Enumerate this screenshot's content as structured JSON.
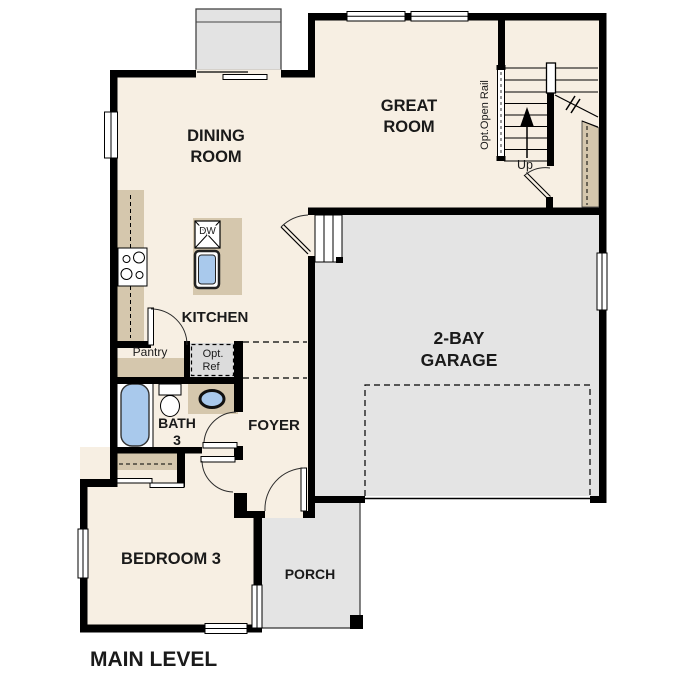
{
  "title": "MAIN LEVEL",
  "rooms": {
    "dining": {
      "line1": "DINING",
      "line2": "ROOM"
    },
    "great": {
      "line1": "GREAT",
      "line2": "ROOM"
    },
    "kitchen": {
      "label": "KITCHEN"
    },
    "garage": {
      "line1": "2-BAY",
      "line2": "GARAGE"
    },
    "bath": {
      "line1": "BATH",
      "line2": "3"
    },
    "foyer": {
      "label": "FOYER"
    },
    "bedroom": {
      "label": "BEDROOM 3"
    },
    "porch": {
      "label": "PORCH"
    },
    "pantry": {
      "label": "Pantry"
    }
  },
  "annotations": {
    "opt_ref_line1": "Opt.",
    "opt_ref_line2": "Ref",
    "stairs_up": "Up",
    "open_rail": "Opt.Open Rail",
    "dishwasher": "DW"
  },
  "colors": {
    "floor": "#f7efe3",
    "garage_floor": "#e4e4e4",
    "cabinetry": "#d5c7ad",
    "fixture_blue": "#a9c9ec",
    "optional_fill": "#dcdcdc",
    "wall": "#000000"
  }
}
